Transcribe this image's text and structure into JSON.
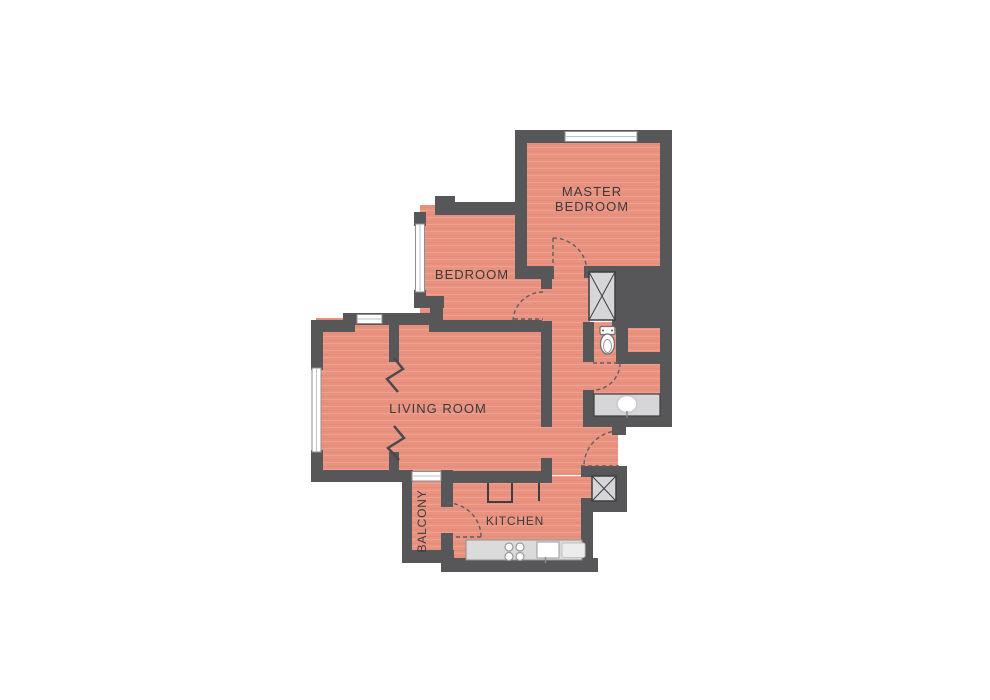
{
  "title": "Apartment floor plan",
  "colors": {
    "wall": "#57575a",
    "floor": "#ea9280",
    "fixture": "#d6d6d8",
    "counter": "#dbdbdb",
    "outline": "#3e3e40",
    "arc": "#5f5f62",
    "text": "#3a3a3c",
    "window": "#ffffff",
    "background": "#ffffff"
  },
  "rooms": {
    "master_bedroom": {
      "label_line1": "MASTER",
      "label_line2": "BEDROOM"
    },
    "bedroom": {
      "label": "BEDROOM"
    },
    "living_room": {
      "label": "LIVING ROOM"
    },
    "kitchen": {
      "label": "KITCHEN"
    },
    "balcony": {
      "label": "BALCONY"
    }
  }
}
